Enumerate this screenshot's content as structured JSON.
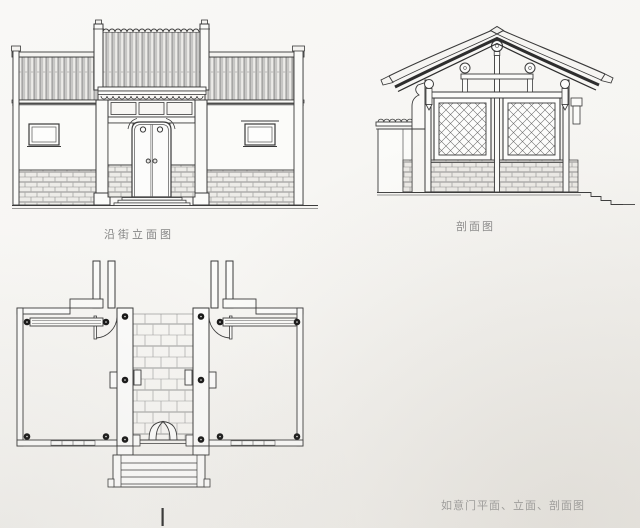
{
  "page": {
    "paper_color": "#f6f5f2",
    "ink_color": "#3a3a3a"
  },
  "captions": {
    "elevation": "沿街立面图",
    "section": "剖面图",
    "footer": "如意门平面、立面、剖面图"
  }
}
